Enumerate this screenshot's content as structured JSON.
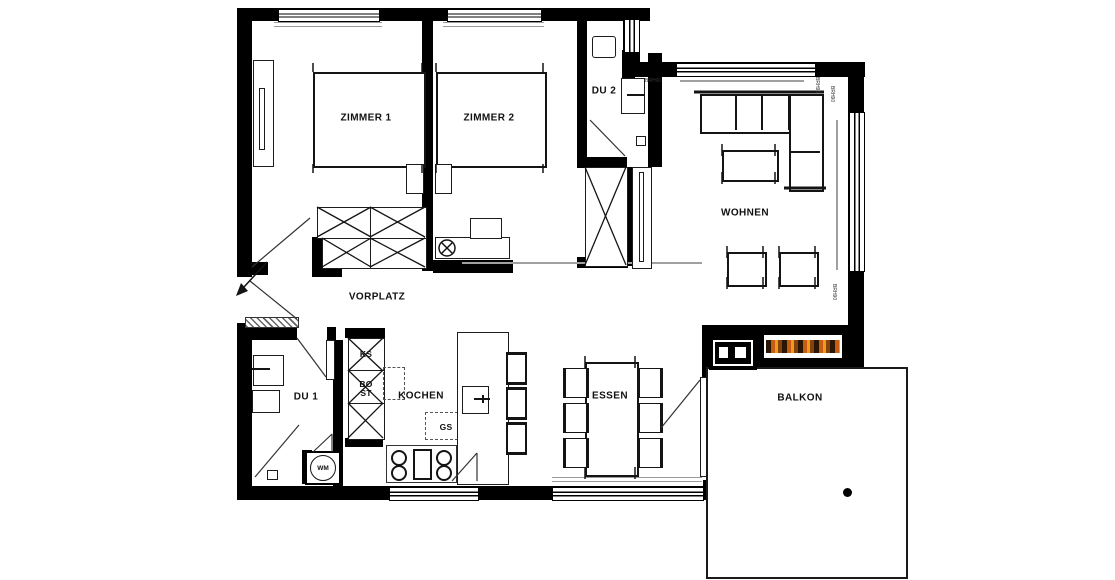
{
  "plan": {
    "type": "apartment-floor-plan",
    "labels": {
      "zimmer1": "ZIMMER 1",
      "zimmer2": "ZIMMER 2",
      "du2": "DU 2",
      "wohnen": "WOHNEN",
      "vorplatz": "VORPLATZ",
      "du1": "DU 1",
      "kochen": "KOCHEN",
      "essen": "ESSEN",
      "balkon": "BALKON",
      "ks": "KS",
      "bo": "BO",
      "st": "ST",
      "gs": "GS",
      "wm": "WM"
    },
    "annotations": {
      "a1": "BRH90",
      "a2": "BRH90",
      "a3": "BRH90",
      "a4": "BRH90"
    },
    "colors": {
      "wall": "#000000",
      "line": "#141414",
      "gray": "#9a9a9a",
      "fire_orange": "#c65d12",
      "background": "#ffffff"
    }
  }
}
